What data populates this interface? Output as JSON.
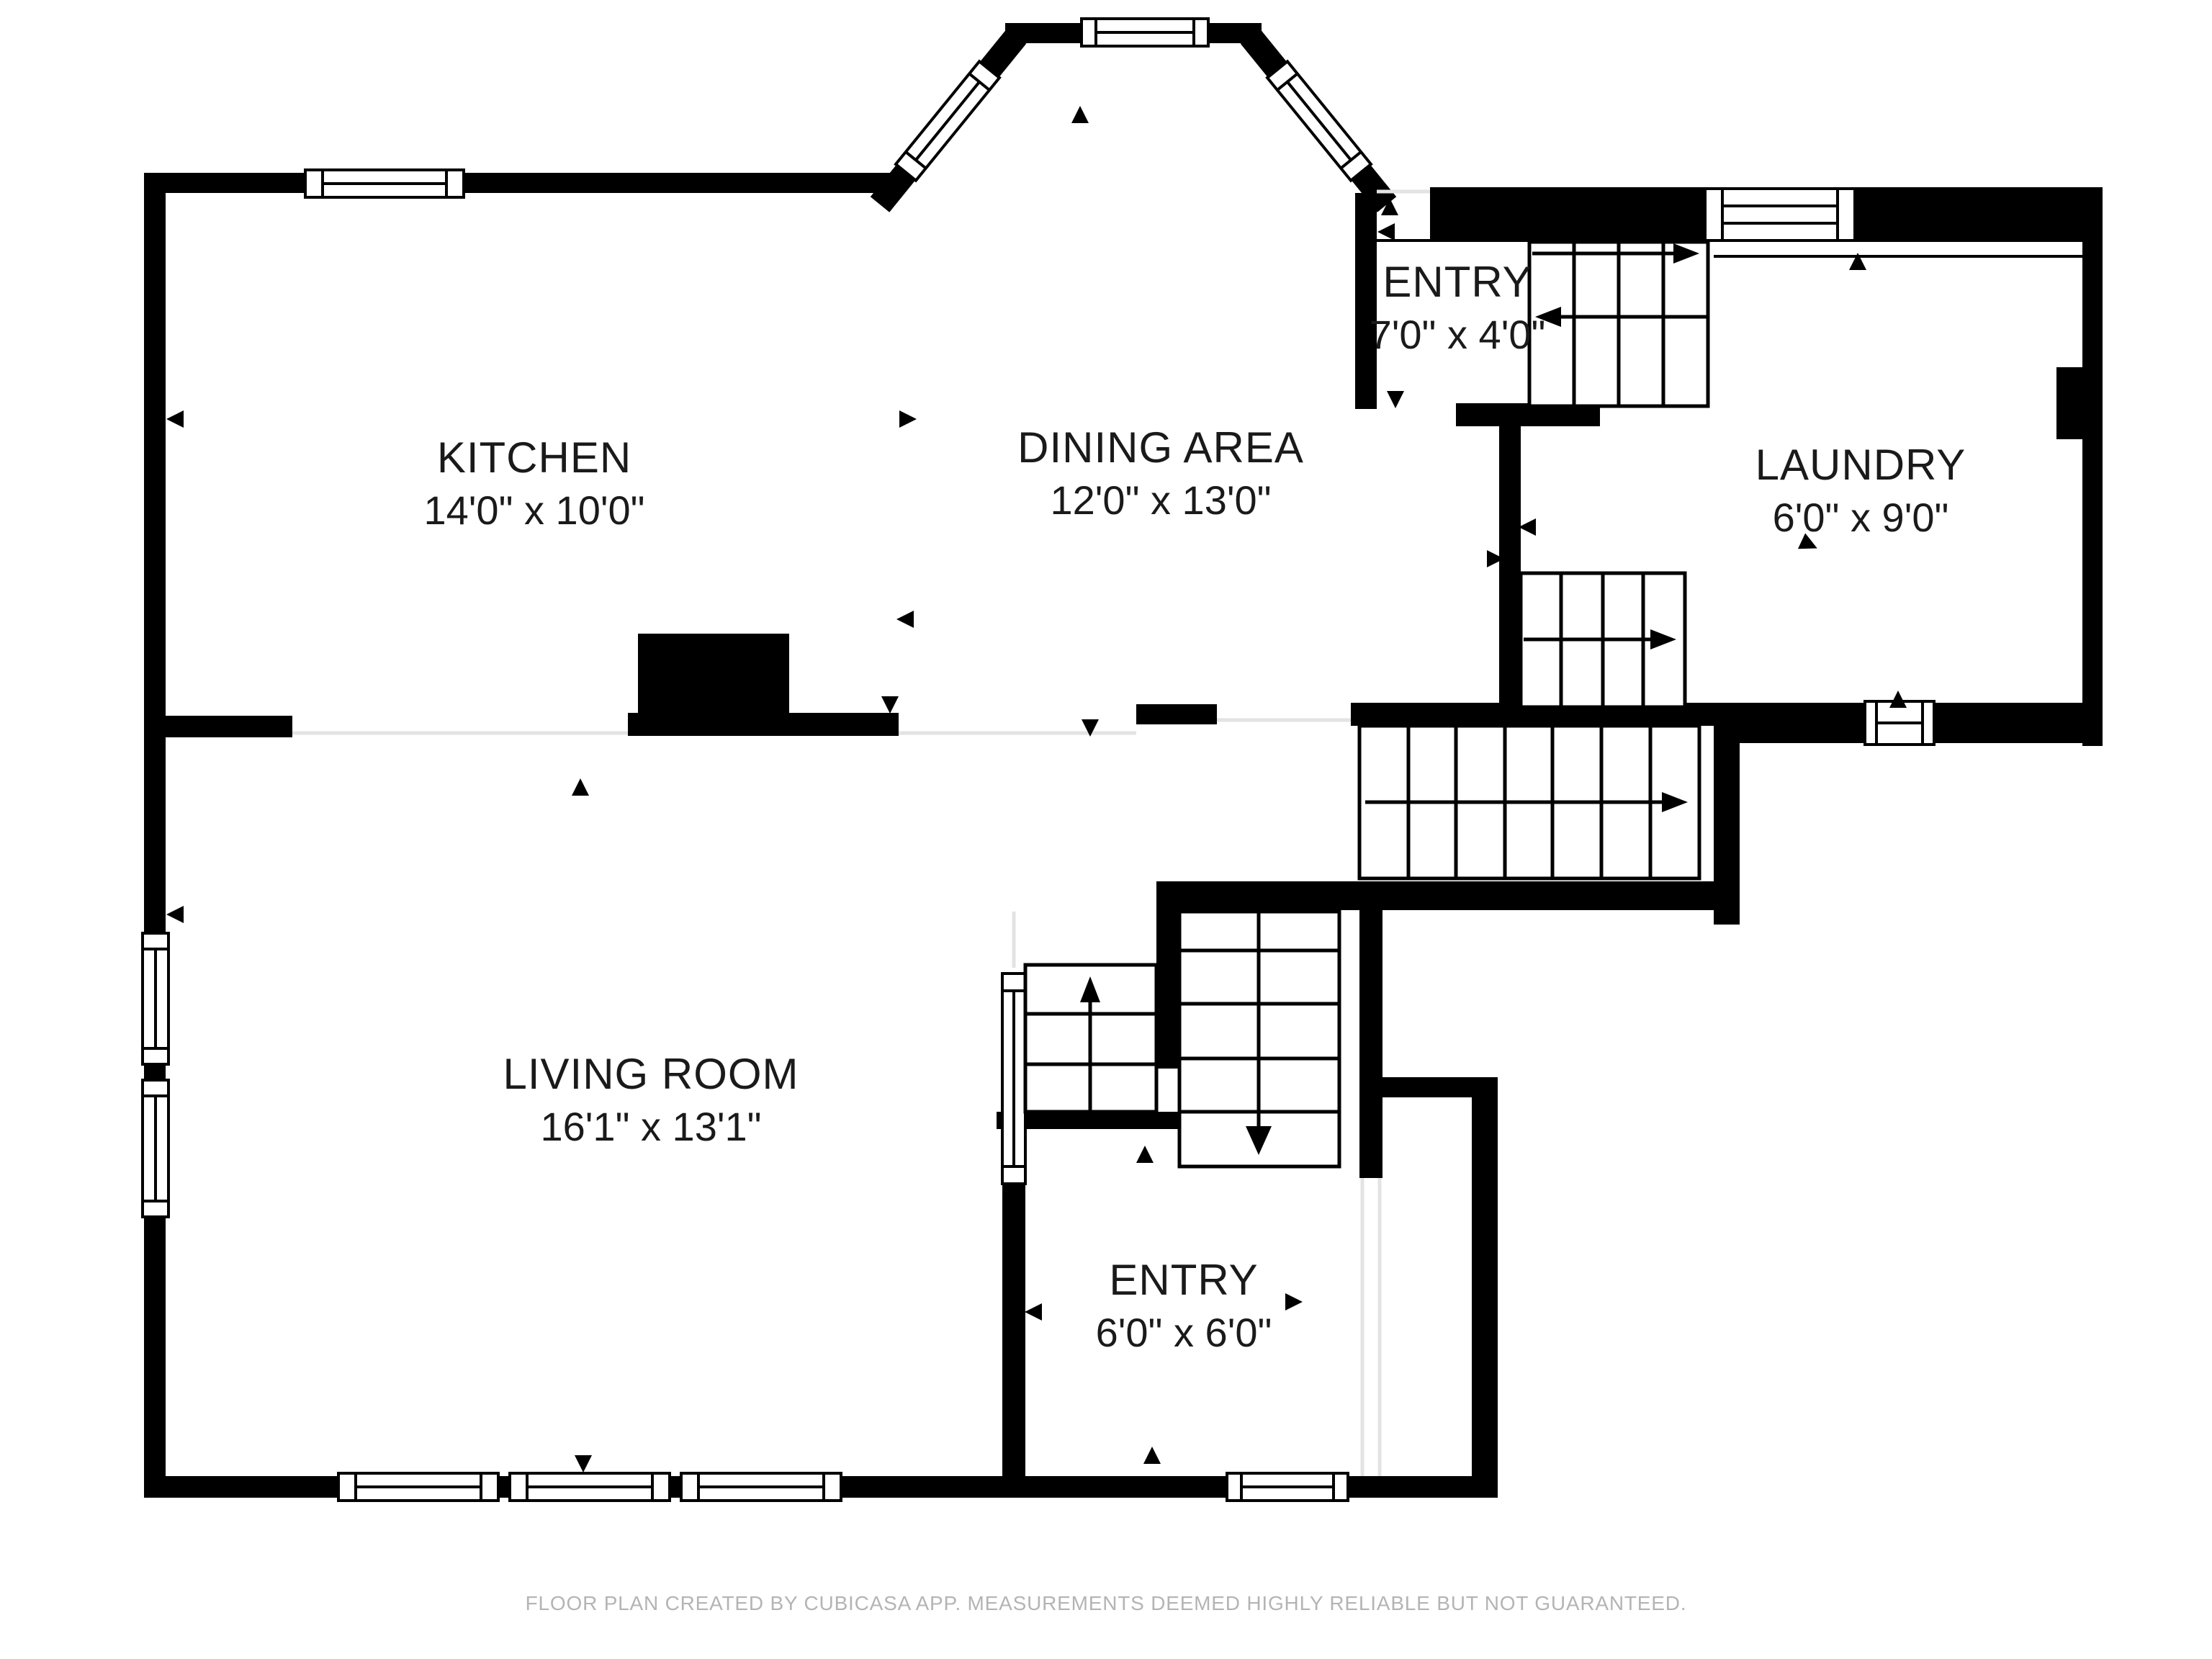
{
  "title": "First floor plan - CubiCasa",
  "rooms": [
    {
      "id": "kitchen",
      "name": "KITCHEN",
      "dims": "14'0\" x 10'0\""
    },
    {
      "id": "dining-area",
      "name": "DINING AREA",
      "dims": "12'0\" x 13'0\""
    },
    {
      "id": "entry-upper",
      "name": "ENTRY",
      "dims": "7'0\" x 4'0\""
    },
    {
      "id": "laundry",
      "name": "LAUNDRY",
      "dims": "6'0\" x 9'0\""
    },
    {
      "id": "living-room",
      "name": "LIVING ROOM",
      "dims": "16'1\" x 13'1\""
    },
    {
      "id": "entry-lower",
      "name": "ENTRY",
      "dims": "6'0\" x 6'0\""
    }
  ],
  "footer": {
    "text": "FLOOR PLAN CREATED BY CUBICASA APP. MEASUREMENTS DEEMED HIGHLY RELIABLE BUT NOT GUARANTEED."
  },
  "colors": {
    "wall": "#000000",
    "floor": "#ffffff",
    "open_boundary": "#e3e3e3",
    "label_text": "#1a1a1a",
    "footer_text": "#b4b4b4"
  }
}
